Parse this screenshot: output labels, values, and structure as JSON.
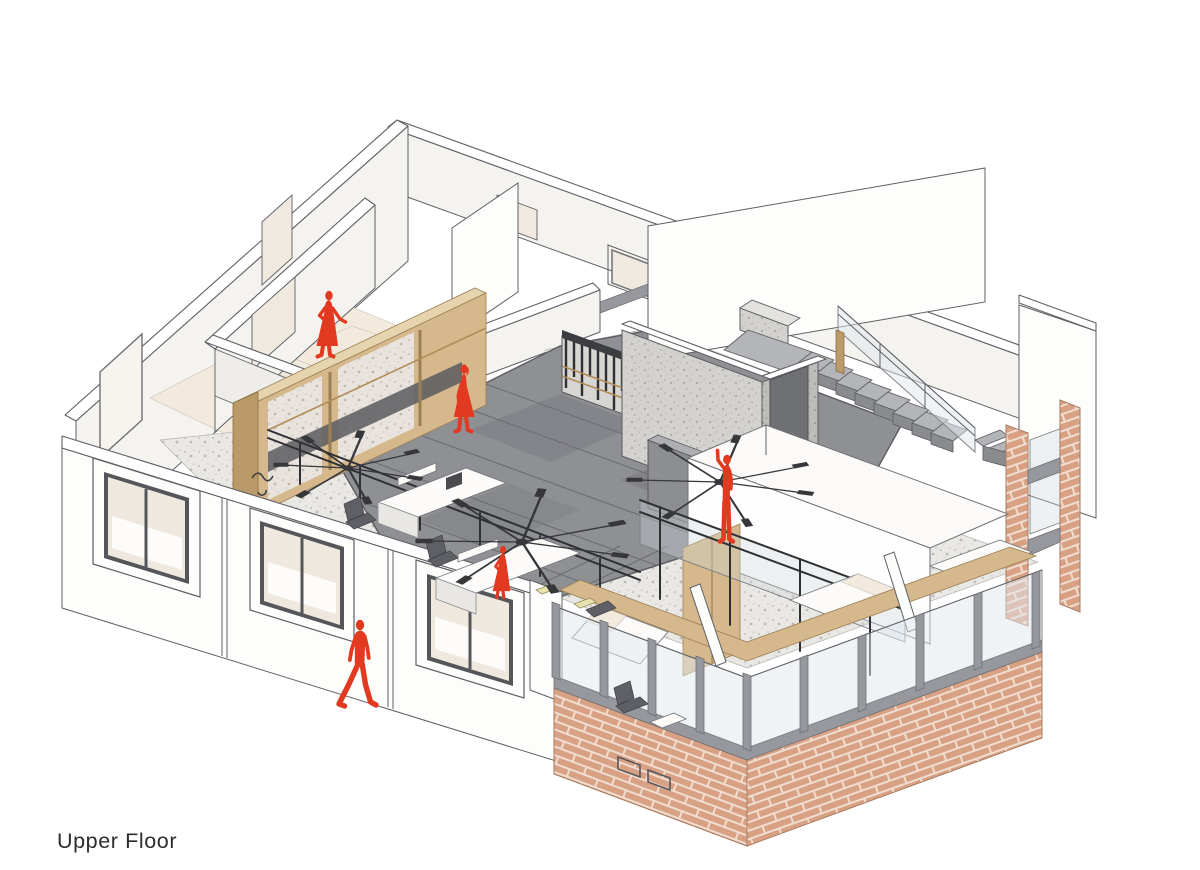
{
  "caption": {
    "label": "Upper Floor"
  },
  "drawing": {
    "type": "axonometric cutaway floor plan",
    "floor_name": "Upper Floor",
    "occupants": [
      {
        "id": "woman-dress-hall",
        "pose": "standing, hand on hip",
        "location": "upper-left corridor"
      },
      {
        "id": "woman-dress-center",
        "pose": "walking",
        "location": "central corridor on tiled floor"
      },
      {
        "id": "woman-at-desk",
        "pose": "standing at workstation",
        "location": "open office area"
      },
      {
        "id": "man-walking",
        "pose": "walking",
        "location": "outside lower-left facade"
      },
      {
        "id": "man-reaching",
        "pose": "arm raised against wall",
        "location": "center-right by concrete wall"
      }
    ],
    "rooms_visible": [
      "bedrooms",
      "open office",
      "corridor",
      "staircase hall",
      "glazed front bedrooms"
    ],
    "palette": {
      "red": "#e23a20",
      "line": "#5f6065",
      "text": "#2c2c2c",
      "wall-top": "#ffffff",
      "wall": "#f5f3ef",
      "white": "#fdfdfc",
      "floor-beige": "#f2eadd",
      "floor-tile": "#8f9094",
      "tile-joint": "#6d6e72",
      "terrazzo-base": "#eae8e5",
      "concrete-base": "#d3d2cf",
      "glass": "#dfe7ee",
      "steel": "#97989d",
      "steel-dark": "#2f3034",
      "wood": "#d5b88c",
      "wood-light": "#e6d4ae",
      "wood-dark": "#bb9a6a",
      "brick": "#d9a184",
      "mortar": "#f0ddd0",
      "brass": "#b08d57",
      "stair": "#b4b5b8",
      "stair-dark": "#8a8b8f"
    }
  }
}
